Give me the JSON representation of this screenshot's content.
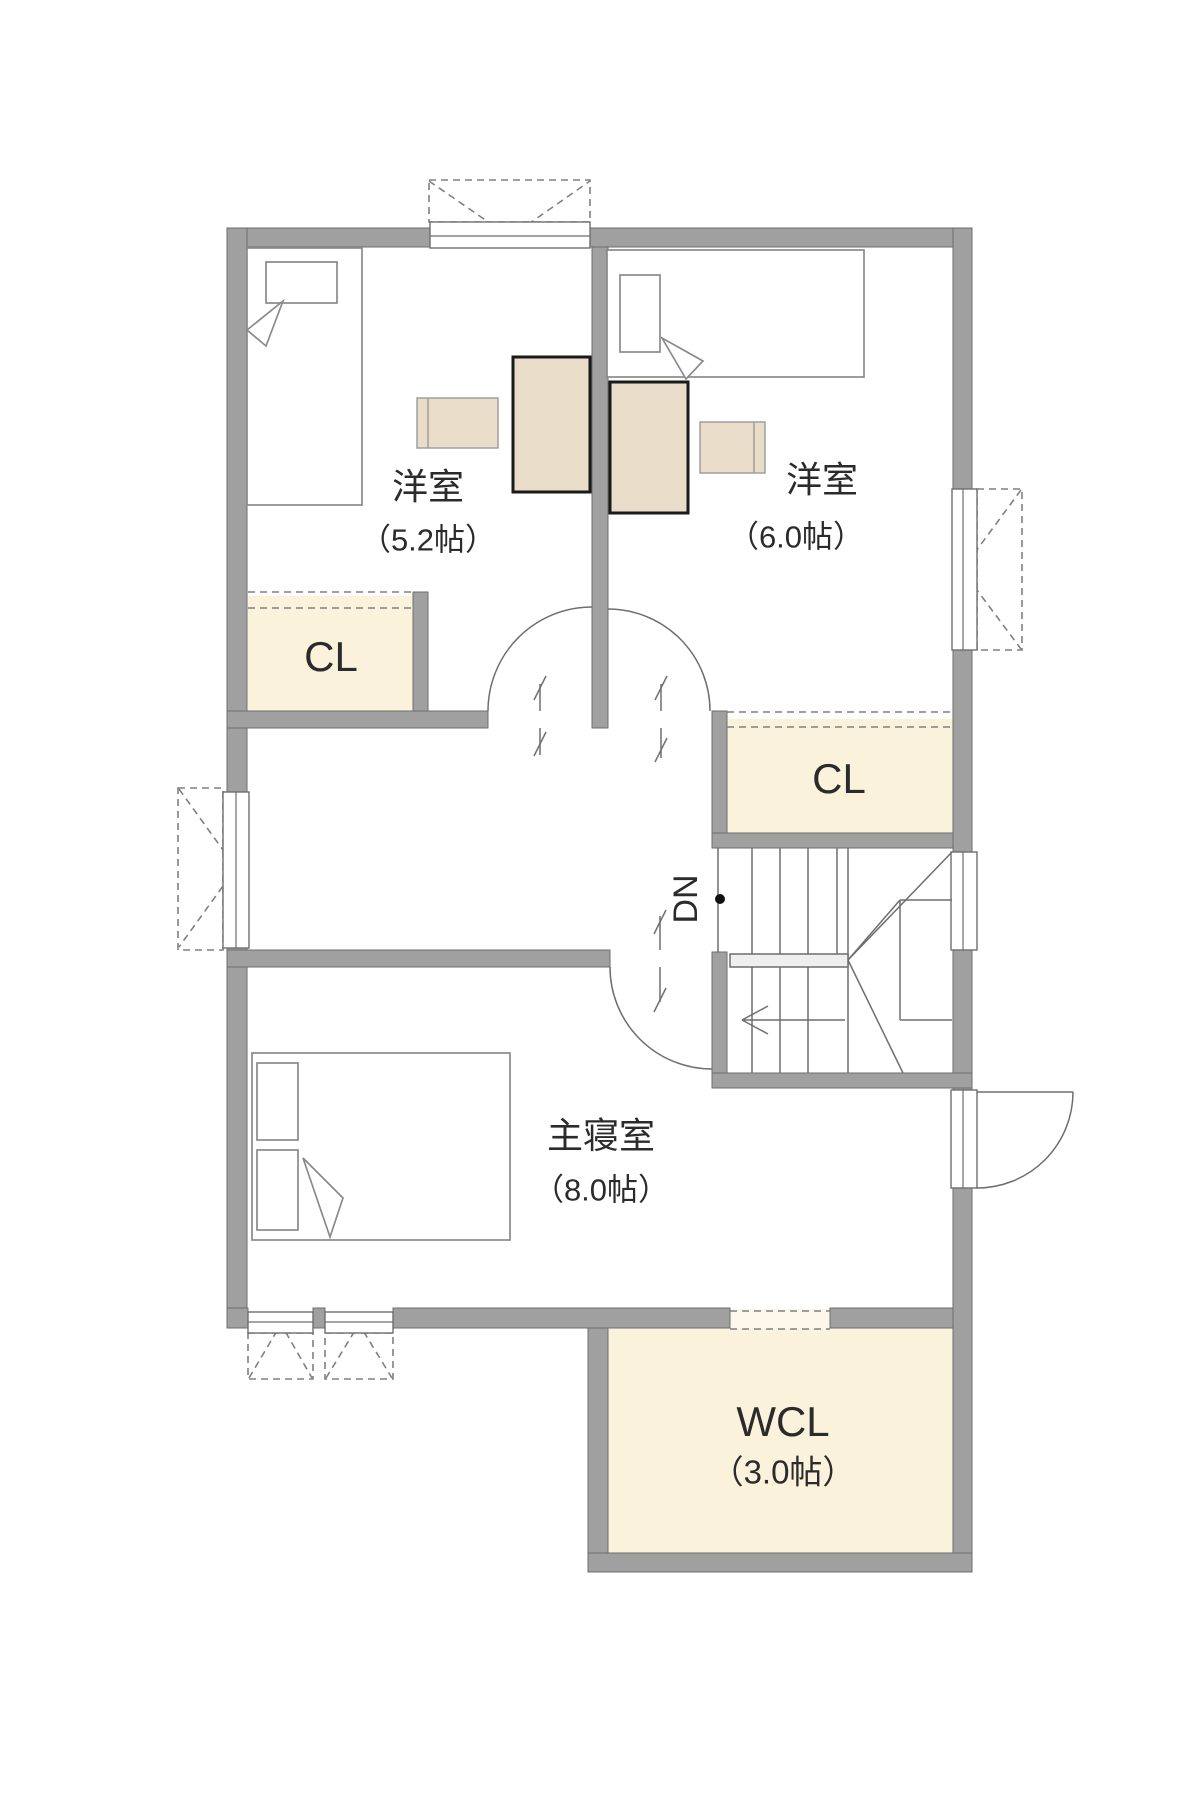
{
  "plan_type": "floor-plan-2f",
  "colors": {
    "wall": "#A0A0A0",
    "wall_outline": "#6E6E6E",
    "closet_fill": "#FBF2DC",
    "closet_door_fill": "#FDF8EA",
    "furniture_fill": "#E9DCC9",
    "furniture_outline": "#1A1A1A",
    "line": "#6E6E6E",
    "text": "#2B2B2B",
    "rail_fill": "#EFEFEF",
    "bed_outline": "#8A8A8A",
    "dash": "#808080",
    "background": "#FFFFFF"
  },
  "rooms": [
    {
      "id": "bedroom-1",
      "name": "洋室",
      "size": "（5.2帖）",
      "furniture": [
        "single-bed",
        "desk",
        "chair"
      ]
    },
    {
      "id": "bedroom-2",
      "name": "洋室",
      "size": "（6.0帖）",
      "furniture": [
        "single-bed",
        "desk",
        "chair"
      ]
    },
    {
      "id": "master-bedroom",
      "name": "主寝室",
      "size": "（8.0帖）",
      "furniture": [
        "double-bed"
      ]
    },
    {
      "id": "walk-in-closet",
      "name": "WCL",
      "size": "（3.0帖）",
      "furniture": []
    }
  ],
  "closets": [
    {
      "id": "closet-bedroom-1",
      "label": "CL"
    },
    {
      "id": "closet-bedroom-2",
      "label": "CL"
    }
  ],
  "stairs": {
    "label": "DN"
  }
}
